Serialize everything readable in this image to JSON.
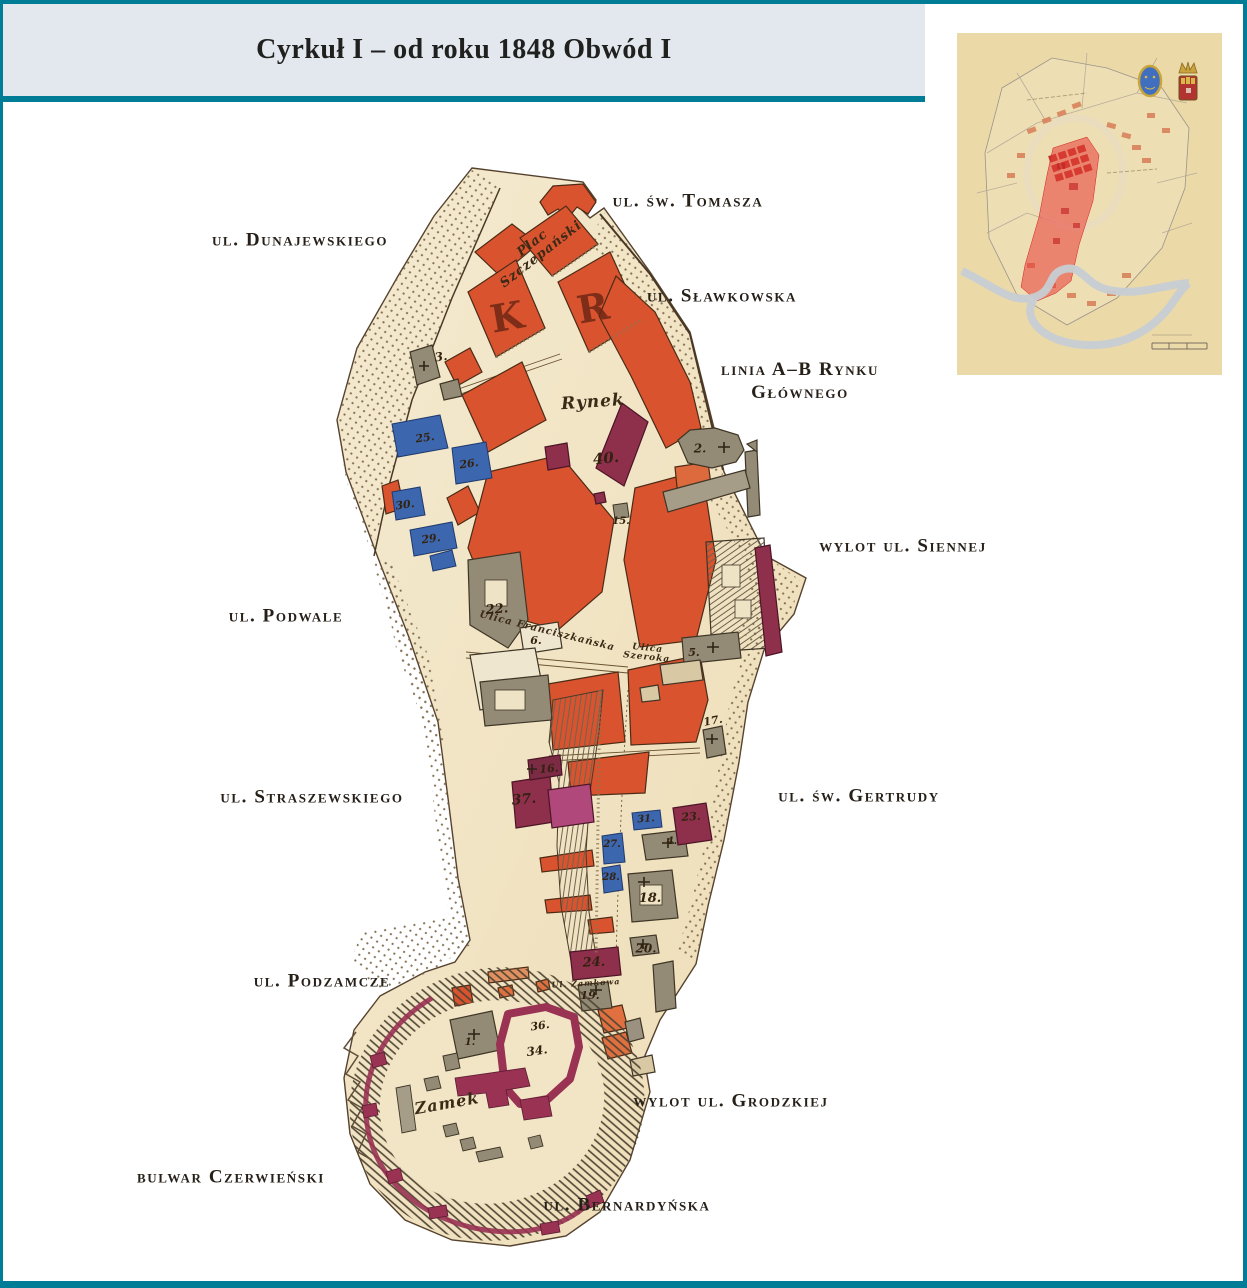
{
  "page": {
    "title": "Cyrkuł I – od roku 1848 Obwód I"
  },
  "colors": {
    "frame_teal": "#007d96",
    "header_bg": "#e2e8ee",
    "map_paper": "#f2e5c5",
    "red_block": "#d9532f",
    "blue_block": "#3c66ae",
    "purple_block": "#8e2f4c",
    "gray_block": "#938b76",
    "inset_highlight": "#ea3a35"
  },
  "street_labels": [
    {
      "id": "ul-sw-tomasza",
      "text": "ul. św. Tomasza",
      "x": 688,
      "y": 202
    },
    {
      "id": "ul-dunajewskiego",
      "text": "ul. Dunajewskiego",
      "x": 300,
      "y": 241
    },
    {
      "id": "ul-slawkowska",
      "text": "ul. Sławkowska",
      "x": 722,
      "y": 297
    },
    {
      "id": "linia-ab-rynku",
      "text": "linia A–B Rynku\nGłównego",
      "x": 800,
      "y": 382
    },
    {
      "id": "wylot-ul-siennej",
      "text": "wylot ul. Siennej",
      "x": 903,
      "y": 547
    },
    {
      "id": "ul-podwale",
      "text": "ul. Podwale",
      "x": 286,
      "y": 617
    },
    {
      "id": "ul-straszewskiego",
      "text": "ul. Straszewskiego",
      "x": 312,
      "y": 798
    },
    {
      "id": "ul-sw-gertrudy",
      "text": "ul. św. Gertrudy",
      "x": 859,
      "y": 797
    },
    {
      "id": "ul-podzamcze",
      "text": "ul. Podzamcze",
      "x": 322,
      "y": 982
    },
    {
      "id": "wylot-ul-grodzkiej",
      "text": "wylot ul. Grodzkiej",
      "x": 731,
      "y": 1102
    },
    {
      "id": "bulwar-czerwienski",
      "text": "bulwar Czerwieński",
      "x": 231,
      "y": 1178
    },
    {
      "id": "ul-bernardynska",
      "text": "ul. Bernardyńska",
      "x": 627,
      "y": 1206
    }
  ],
  "map_labels": [
    {
      "t": "Plac\nSzczepański",
      "x": 537,
      "y": 249,
      "r": -38,
      "s": 13,
      "k": "place"
    },
    {
      "t": "Rynek",
      "x": 593,
      "y": 403,
      "r": -4,
      "s": 17,
      "k": "place"
    },
    {
      "t": "Ulica Franciszkańska",
      "x": 547,
      "y": 632,
      "r": 14,
      "s": 10,
      "k": "place"
    },
    {
      "t": "Ulica\nSzeroka",
      "x": 647,
      "y": 654,
      "r": 6,
      "s": 9,
      "k": "place"
    },
    {
      "t": "Zamek",
      "x": 447,
      "y": 1104,
      "r": -10,
      "s": 16,
      "k": "place"
    },
    {
      "t": "Ul. Zamkowa",
      "x": 586,
      "y": 983,
      "r": -3,
      "s": 8,
      "k": "place"
    },
    {
      "t": "K",
      "x": 507,
      "y": 317,
      "r": -10,
      "s": 38,
      "k": "letter"
    },
    {
      "t": "R",
      "x": 593,
      "y": 308,
      "r": -10,
      "s": 38,
      "k": "letter"
    },
    {
      "t": "3.",
      "x": 441,
      "y": 357,
      "r": -8,
      "s": 12,
      "k": "num"
    },
    {
      "t": "25.",
      "x": 425,
      "y": 438,
      "r": -8,
      "s": 11,
      "k": "num"
    },
    {
      "t": "26.",
      "x": 469,
      "y": 464,
      "r": -8,
      "s": 11,
      "k": "num"
    },
    {
      "t": "30.",
      "x": 405,
      "y": 505,
      "r": -8,
      "s": 11,
      "k": "num"
    },
    {
      "t": "29.",
      "x": 431,
      "y": 539,
      "r": -8,
      "s": 11,
      "k": "num"
    },
    {
      "t": "40.",
      "x": 606,
      "y": 459,
      "r": -6,
      "s": 15,
      "k": "num"
    },
    {
      "t": "2.",
      "x": 700,
      "y": 449,
      "r": 0,
      "s": 12,
      "k": "num"
    },
    {
      "t": "15.",
      "x": 621,
      "y": 522,
      "r": 0,
      "s": 10,
      "k": "num"
    },
    {
      "t": "22.",
      "x": 497,
      "y": 610,
      "r": -5,
      "s": 13,
      "k": "num"
    },
    {
      "t": "6.",
      "x": 536,
      "y": 641,
      "r": 0,
      "s": 11,
      "k": "num"
    },
    {
      "t": "5.",
      "x": 694,
      "y": 653,
      "r": 0,
      "s": 11,
      "k": "num"
    },
    {
      "t": "17.",
      "x": 713,
      "y": 721,
      "r": -10,
      "s": 11,
      "k": "num"
    },
    {
      "t": "16.",
      "x": 549,
      "y": 769,
      "r": -5,
      "s": 11,
      "k": "num"
    },
    {
      "t": "37.",
      "x": 524,
      "y": 800,
      "r": -5,
      "s": 14,
      "k": "num"
    },
    {
      "t": "31.",
      "x": 646,
      "y": 820,
      "r": -4,
      "s": 10,
      "k": "num"
    },
    {
      "t": "23.",
      "x": 691,
      "y": 817,
      "r": -4,
      "s": 11,
      "k": "num"
    },
    {
      "t": "27.",
      "x": 612,
      "y": 845,
      "r": 0,
      "s": 10,
      "k": "num"
    },
    {
      "t": "28.",
      "x": 611,
      "y": 878,
      "r": 0,
      "s": 10,
      "k": "num"
    },
    {
      "t": "4.",
      "x": 672,
      "y": 842,
      "r": 0,
      "s": 10,
      "k": "num"
    },
    {
      "t": "18.",
      "x": 650,
      "y": 899,
      "r": 0,
      "s": 13,
      "k": "num"
    },
    {
      "t": "20.",
      "x": 646,
      "y": 949,
      "r": 0,
      "s": 12,
      "k": "num"
    },
    {
      "t": "24.",
      "x": 594,
      "y": 963,
      "r": -3,
      "s": 13,
      "k": "num"
    },
    {
      "t": "19.",
      "x": 590,
      "y": 996,
      "r": 0,
      "s": 11,
      "k": "num"
    },
    {
      "t": "36.",
      "x": 540,
      "y": 1026,
      "r": -8,
      "s": 11,
      "k": "num"
    },
    {
      "t": "34.",
      "x": 537,
      "y": 1051,
      "r": -8,
      "s": 12,
      "k": "num"
    },
    {
      "t": "1.",
      "x": 470,
      "y": 1043,
      "r": 0,
      "s": 10,
      "k": "num"
    }
  ]
}
